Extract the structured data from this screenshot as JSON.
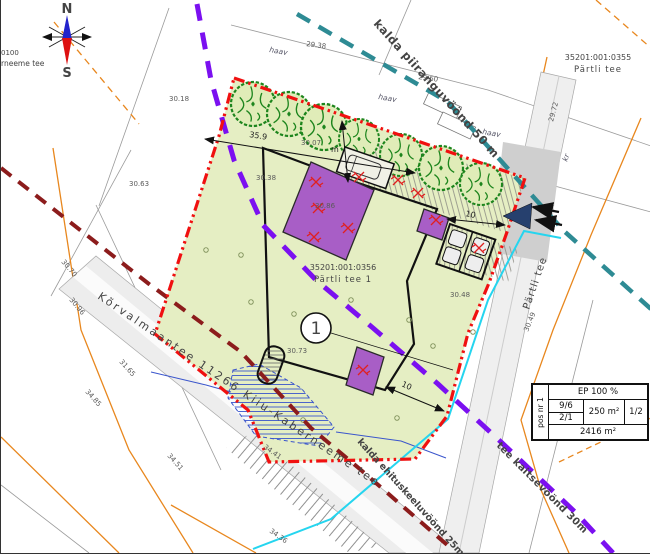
{
  "compass": {
    "north_label": "N",
    "south_label": "S"
  },
  "corner_text": {
    "line1": "0100",
    "line2": "rneeme tee"
  },
  "parcels": {
    "adjacent": {
      "code": "35201:001:0355",
      "name": "Pärtli tee"
    },
    "main": {
      "code": "35201:001:0356",
      "name": "Pärtli tee 1"
    }
  },
  "zones": {
    "shore_limit": {
      "label": "kalda piiranguvöönd 50 m",
      "color": "#2e8b94"
    },
    "road_protection": {
      "label": "tee kaitsevöönd 30m",
      "color": "#8010e8"
    },
    "building_exclusion": {
      "label": "kalda ehituskeeluvöönd 25m",
      "color": "#8c1c1c"
    }
  },
  "roads": {
    "main_road_label": "Kõrvalmaantee 11266 Kiiu-Kaberneeme tee",
    "side_road_label": "Pärtli tee"
  },
  "plot": {
    "position_number": "1",
    "boundary_color": "#f01010",
    "fill_color": "#e5eec3",
    "building_fill": "#a85ec6"
  },
  "dimensions": {
    "d1": "35.9",
    "d2": "m",
    "d3": "10",
    "d4": "10"
  },
  "info_table": {
    "pos": "pos nr 1",
    "row1": "EP 100 %",
    "storeys": "9/6",
    "ratio": "2/1",
    "area": "250 m²",
    "fraction": "1/2",
    "total_area": "2416 m²"
  },
  "vegetation_labels": [
    {
      "t": "haav",
      "x": 268,
      "y": 52,
      "r": 10
    },
    {
      "t": "haav",
      "x": 377,
      "y": 99,
      "r": 10
    },
    {
      "t": "haav",
      "x": 481,
      "y": 134,
      "r": 10
    },
    {
      "t": "kr",
      "x": 566,
      "y": 162,
      "r": -70
    }
  ],
  "elevations": [
    {
      "t": "30.18",
      "x": 168,
      "y": 101,
      "r": 0
    },
    {
      "t": "30.63",
      "x": 128,
      "y": 186,
      "r": 0
    },
    {
      "t": "29.38",
      "x": 305,
      "y": 46,
      "r": 8
    },
    {
      "t": "29.60",
      "x": 417,
      "y": 79,
      "r": 8
    },
    {
      "t": "30.38",
      "x": 255,
      "y": 180,
      "r": 0
    },
    {
      "t": "30.07",
      "x": 300,
      "y": 145,
      "r": 0
    },
    {
      "t": "30.86",
      "x": 314,
      "y": 208,
      "r": 0
    },
    {
      "t": "30.73",
      "x": 286,
      "y": 353,
      "r": 0
    },
    {
      "t": "30.48",
      "x": 449,
      "y": 297,
      "r": 0
    },
    {
      "t": "30.49",
      "x": 527,
      "y": 332,
      "r": -68
    },
    {
      "t": "29.72",
      "x": 552,
      "y": 122,
      "r": -75
    },
    {
      "t": "30.70",
      "x": 60,
      "y": 262,
      "r": 50
    },
    {
      "t": "30.96",
      "x": 68,
      "y": 300,
      "r": 50
    },
    {
      "t": "31.65",
      "x": 118,
      "y": 362,
      "r": 48
    },
    {
      "t": "34.85",
      "x": 84,
      "y": 392,
      "r": 48
    },
    {
      "t": "34.51",
      "x": 166,
      "y": 456,
      "r": 48
    },
    {
      "t": "34.41",
      "x": 262,
      "y": 448,
      "r": 35
    },
    {
      "t": "34.36",
      "x": 268,
      "y": 532,
      "r": 35
    }
  ]
}
